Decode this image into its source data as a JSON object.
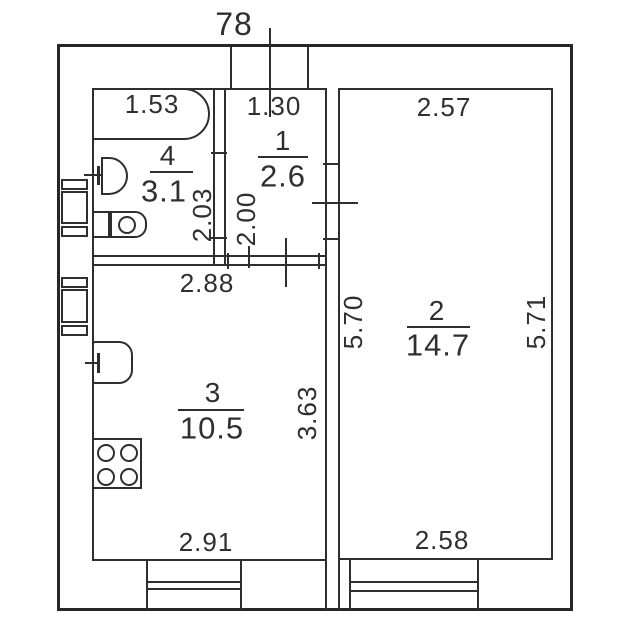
{
  "plan": {
    "top_label": "78",
    "rooms": [
      {
        "number": "1",
        "area": "2.6"
      },
      {
        "number": "2",
        "area": "14.7"
      },
      {
        "number": "3",
        "area": "10.5"
      },
      {
        "number": "4",
        "area": "3.1"
      }
    ],
    "dimensions": {
      "bathroom_width": "1.53",
      "hall_width": "1.30",
      "room2_top_width": "2.57",
      "bathroom_depth": "2.03",
      "hall_depth": "2.00",
      "kitchen_top_width": "2.88",
      "room2_left_height": "5.70",
      "room2_right_height": "5.71",
      "kitchen_height": "3.63",
      "kitchen_bottom_width": "2.91",
      "room2_bottom_width": "2.58"
    },
    "colors": {
      "line": "#2e2e2e",
      "background": "#ffffff"
    }
  }
}
